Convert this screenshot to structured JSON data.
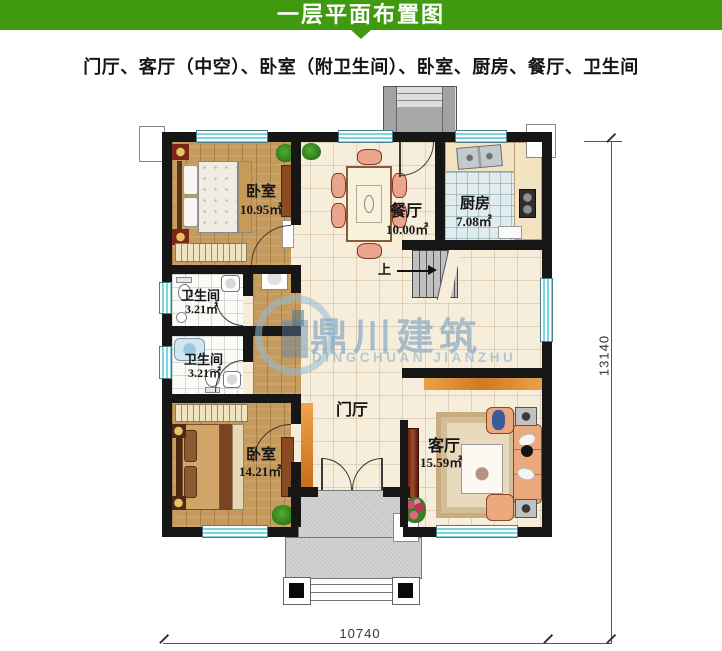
{
  "header": {
    "title": "一层平面布置图"
  },
  "subtitle": "门厅、客厅（中空）、卧室（附卫生间）、卧室、厨房、餐厅、卫生间",
  "watermark": {
    "cn": "鼎川建筑",
    "en": "DINGCHUAN JIANZHU"
  },
  "rooms": {
    "bedroom_top": {
      "name": "卧室",
      "area": "10.95㎡"
    },
    "dining": {
      "name": "餐厅",
      "area": "10.00㎡"
    },
    "kitchen": {
      "name": "厨房",
      "area": "7.08㎡"
    },
    "bath_upper": {
      "name": "卫生间",
      "area": "3.21㎡"
    },
    "bath_lower": {
      "name": "卫生间",
      "area": "3.21㎡"
    },
    "bedroom_bottom": {
      "name": "卧室",
      "area": "14.21㎡"
    },
    "foyer": {
      "name": "门厅"
    },
    "living": {
      "name": "客厅",
      "area": "15.59㎡"
    }
  },
  "stairs": {
    "direction_label": "上"
  },
  "dimensions": {
    "bottom_width_mm": "10740",
    "right_height_mm": "13140"
  },
  "colors": {
    "header_green": "#3f9a10",
    "wall_black": "#161616",
    "window_teal": "#7fd4dc",
    "wood_floor": "#c59a5d",
    "tile_cream": "#f6eedb",
    "accent_orange": "#d97a26",
    "watermark_blue": "#9ab8d2"
  }
}
